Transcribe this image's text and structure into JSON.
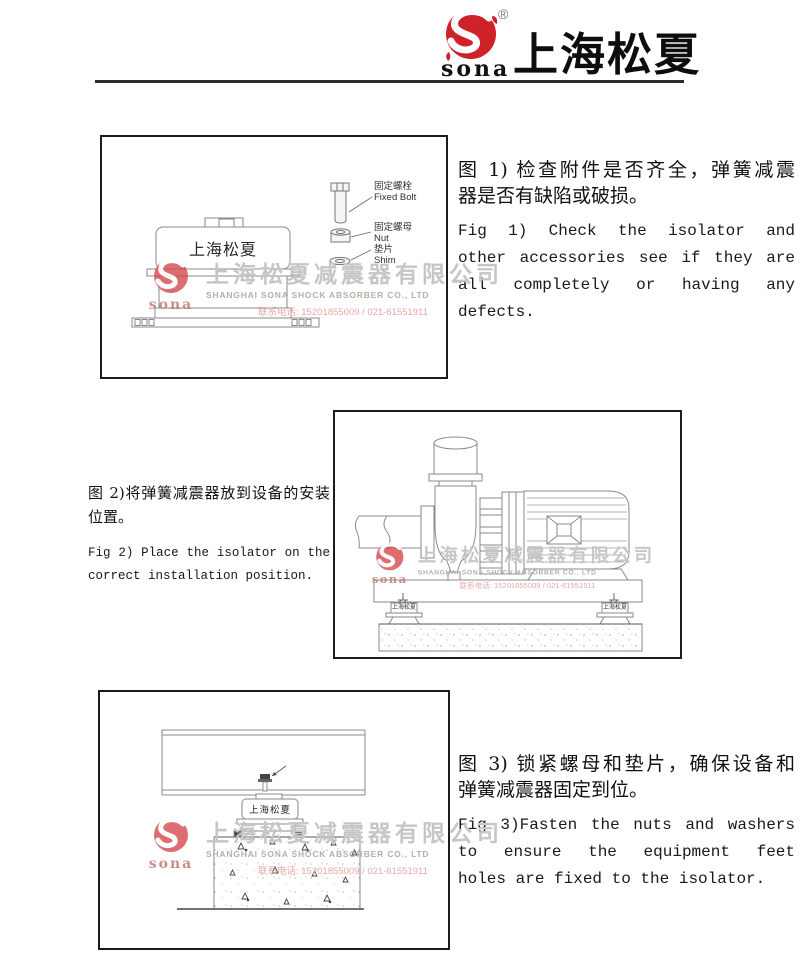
{
  "header": {
    "brand": "上海松夏",
    "logo_text": "sona",
    "registered_mark": "®"
  },
  "figures": {
    "fig1": {
      "cn_lines": [
        "图 1) 检查附件是否齐全，弹簧减震",
        "器是否有缺陷或破损。"
      ],
      "en_lines": [
        "Fig 1) Check the isolator and",
        "other accessories see if they are",
        "all completely or having any",
        "defects."
      ],
      "device_label": "上海松夏",
      "callouts": {
        "bolt_cn": "固定螺栓",
        "bolt_en": "Fixed Bolt",
        "nut_cn": "固定螺母",
        "nut_en": "Nut",
        "shim_cn": "垫片",
        "shim_en": "Shim"
      }
    },
    "fig2": {
      "cn_lines": [
        "图 2)将弹簧减震器放到设备的安装",
        "位置。"
      ],
      "en_lines": [
        "Fig 2) Place the isolator on the",
        "correct installation position."
      ],
      "isolator_label": "上海松夏"
    },
    "fig3": {
      "cn_lines": [
        "图 3) 锁紧螺母和垫片，确保设备和",
        "弹簧减震器固定到位。"
      ],
      "en_lines": [
        "Fig 3)Fasten the nuts and washers",
        "to ensure the equipment feet",
        "holes are fixed to the isolator."
      ],
      "device_label": "上海松夏"
    }
  },
  "watermark": {
    "company_cn": "上海松夏减震器有限公司",
    "company_en": "SHANGHAI SONA SHOCK ABSORBER CO., LTD",
    "phone": "联系电话: 15201855009 / 021-61551911",
    "logo_text": "sona"
  },
  "colors": {
    "brand_red": "#cf2128",
    "box_border": "#1c1c1c",
    "drawing_line": "#888888",
    "watermark_gray": "#c6c6c6",
    "watermark_pink": "#eba8a8"
  }
}
